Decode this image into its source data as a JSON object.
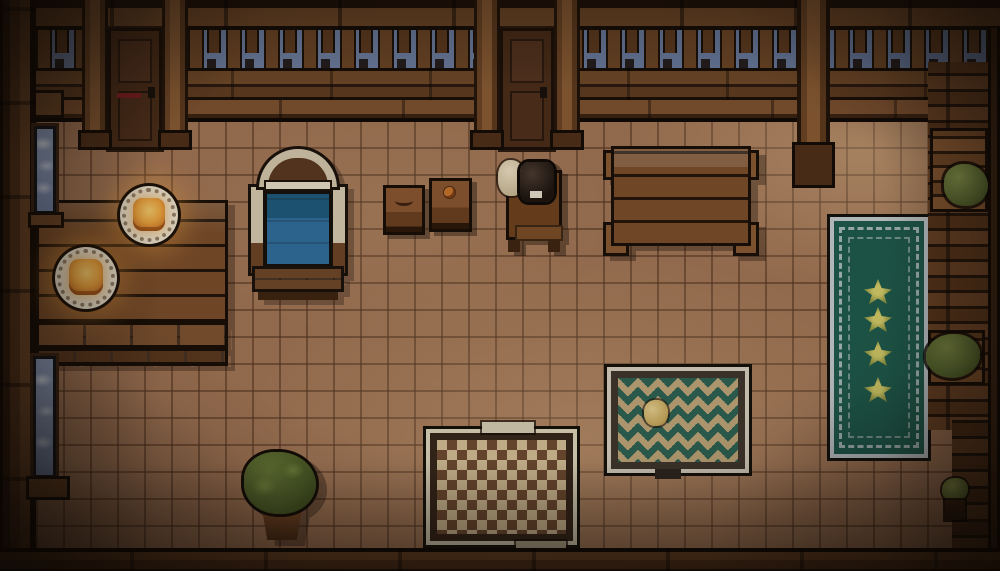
{
  "scene": {
    "title": "Pixel-art tavern interior — top-down room with bed, tables, rugs and balustrade",
    "style": "16-bit pixel art, warm dim candlelit palette, top-down view",
    "palette": {
      "outline": "#17100a",
      "floor_tile": "#a27656",
      "floor_grout": "#7b573d",
      "wood_dark": "#4a2d18",
      "wood_mid": "#6f4828",
      "wood_light": "#8a5c34",
      "sky_blue": "#7487ab",
      "window_blue": "#8ea0c0",
      "bed_blanket_blue": "#2e6f9f",
      "bed_frame_cream": "#d6c9ae",
      "rug_green": "#1d5c4e",
      "rug_border_white": "#c6ced0",
      "diamond_green": "#2c6354",
      "diamond_field_tan": "#c0a87a",
      "checker_light": "#d6c198",
      "checker_dark": "#6e4b31",
      "plant_green": "#5c6e33",
      "glow_orange": "#eda43d",
      "plate_cream": "#ece4d0"
    },
    "objects": {
      "floor": {
        "label": "Terracotta tile floor"
      },
      "top_wall": {
        "label": "North wall with beams and balustrade"
      },
      "balustrade": {
        "label": "Balustrade posts against evening sky"
      },
      "door_left": {
        "label": "Wooden door — north-west"
      },
      "door_center": {
        "label": "Wooden door — north-center"
      },
      "pillar": {
        "label": "Wooden support pillar"
      },
      "corbel": {
        "label": "Wall corbel"
      },
      "left_wall": {
        "label": "West wall"
      },
      "window_upper": {
        "label": "Narrow window — upper west"
      },
      "window_lower": {
        "label": "Narrow window — lower west"
      },
      "right_wall": {
        "label": "East wall shelving"
      },
      "plant_shelf_top": {
        "label": "Bush on upper shelf"
      },
      "plant_shelf_mid": {
        "label": "Bush on middle shelf"
      },
      "plant_potted_small": {
        "label": "Small potted plant"
      },
      "dining_table": {
        "label": "Long wooden dining table"
      },
      "plate_upper": {
        "label": "Plate with glowing food"
      },
      "plate_lower": {
        "label": "Plate with glowing food"
      },
      "bed": {
        "label": "Bed with blue blanket and arched headboard"
      },
      "crate_left": {
        "label": "Wooden crate"
      },
      "crate_right": {
        "label": "Wooden crate"
      },
      "nightstand": {
        "label": "Nightstand with dark jar and flour sack"
      },
      "side_table": {
        "label": "Wooden table — north-east"
      },
      "green_rug": {
        "label": "Green runner rug with flower motifs"
      },
      "diamond_rug": {
        "label": "Tan rug with green diamond pattern"
      },
      "checker_rug": {
        "label": "Checkered rug"
      },
      "potted_bush": {
        "label": "Potted bush"
      },
      "bottom_wall": {
        "label": "South wall"
      }
    }
  }
}
